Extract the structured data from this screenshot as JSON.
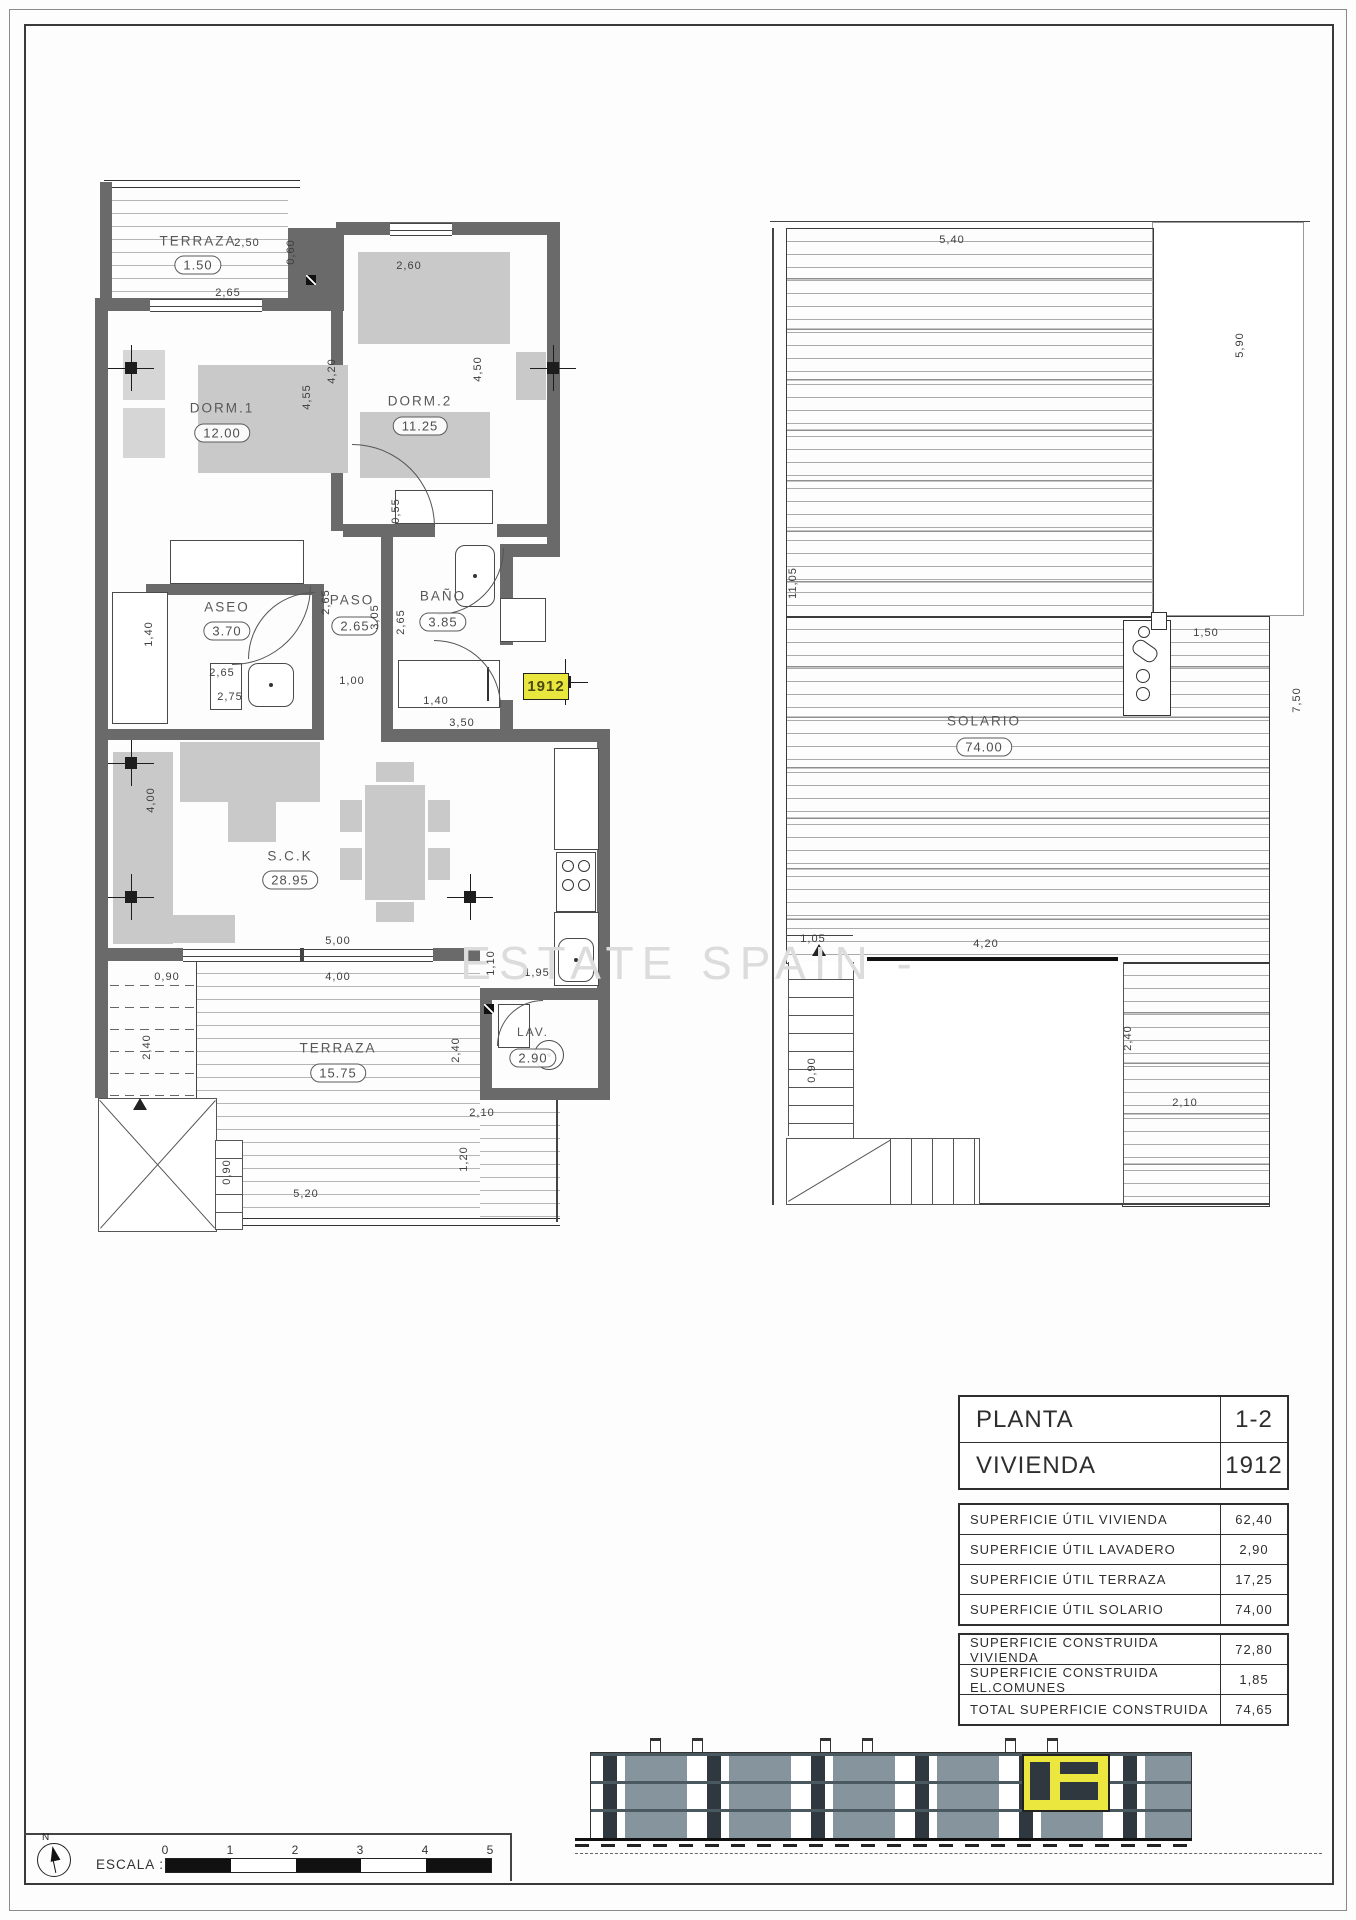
{
  "page": {
    "watermark": "ESTATE SPAIN -",
    "north_label": "N",
    "scale": {
      "label": "ESCALA :",
      "ticks": [
        "0",
        "1",
        "2",
        "3",
        "4",
        "5"
      ]
    }
  },
  "colors": {
    "accent_yellow": "#e9e63d",
    "wall_gray": "#6a6a6a",
    "furniture_gray": "#c9c9c9",
    "balcony_glass": "#86949d"
  },
  "plan_left": {
    "unit_badge": "1912",
    "rooms": [
      {
        "name": "TERRAZA",
        "area": "1.50"
      },
      {
        "name": "DORM.1",
        "area": "12.00"
      },
      {
        "name": "DORM.2",
        "area": "11.25"
      },
      {
        "name": "ASEO",
        "area": "3.70"
      },
      {
        "name": "PASO",
        "area": "2.65"
      },
      {
        "name": "BAÑO",
        "area": "3.85"
      },
      {
        "name": "S.C.K",
        "area": "28.95"
      },
      {
        "name": "TERRAZA",
        "area": "15.75"
      },
      {
        "name": "LAV.",
        "area": "2.90"
      }
    ],
    "dims": [
      "2,50",
      "0,60",
      "2,65",
      "2,60",
      "4,20",
      "4,55",
      "4,50",
      "0,55",
      "1,40",
      "2,65",
      "2,65",
      "3,05",
      "2,65",
      "1,00",
      "2,75",
      "1,40",
      "3,50",
      "4,00",
      "5,00",
      "4,00",
      "0,90",
      "1,10",
      "1,95",
      "2,40",
      "2,40",
      "1,20",
      "0,90",
      "5,20",
      "2,10"
    ]
  },
  "plan_right": {
    "rooms": [
      {
        "name": "SOLARIO",
        "area": "74.00"
      }
    ],
    "dims": [
      "5,40",
      "11,05",
      "5,90",
      "1,50",
      "7,50",
      "1,05",
      "4,20",
      "2,40",
      "0,90",
      "2,10"
    ]
  },
  "tables": {
    "info": {
      "rows": [
        {
          "label": "PLANTA",
          "value": "1-2"
        },
        {
          "label": "VIVIENDA",
          "value": "1912"
        }
      ]
    },
    "util": {
      "rows": [
        {
          "label": "SUPERFICIE ÚTIL VIVIENDA",
          "value": "62,40"
        },
        {
          "label": "SUPERFICIE ÚTIL LAVADERO",
          "value": "2,90"
        },
        {
          "label": "SUPERFICIE ÚTIL TERRAZA",
          "value": "17,25"
        },
        {
          "label": "SUPERFICIE ÚTIL SOLARIO",
          "value": "74,00"
        }
      ]
    },
    "built": {
      "rows": [
        {
          "label": "SUPERFICIE CONSTRUIDA VIVIENDA",
          "value": "72,80"
        },
        {
          "label": "SUPERFICIE CONSTRUIDA EL.COMUNES",
          "value": "1,85"
        },
        {
          "label": "TOTAL SUPERFICIE CONSTRUIDA",
          "value": "74,65"
        }
      ]
    }
  }
}
